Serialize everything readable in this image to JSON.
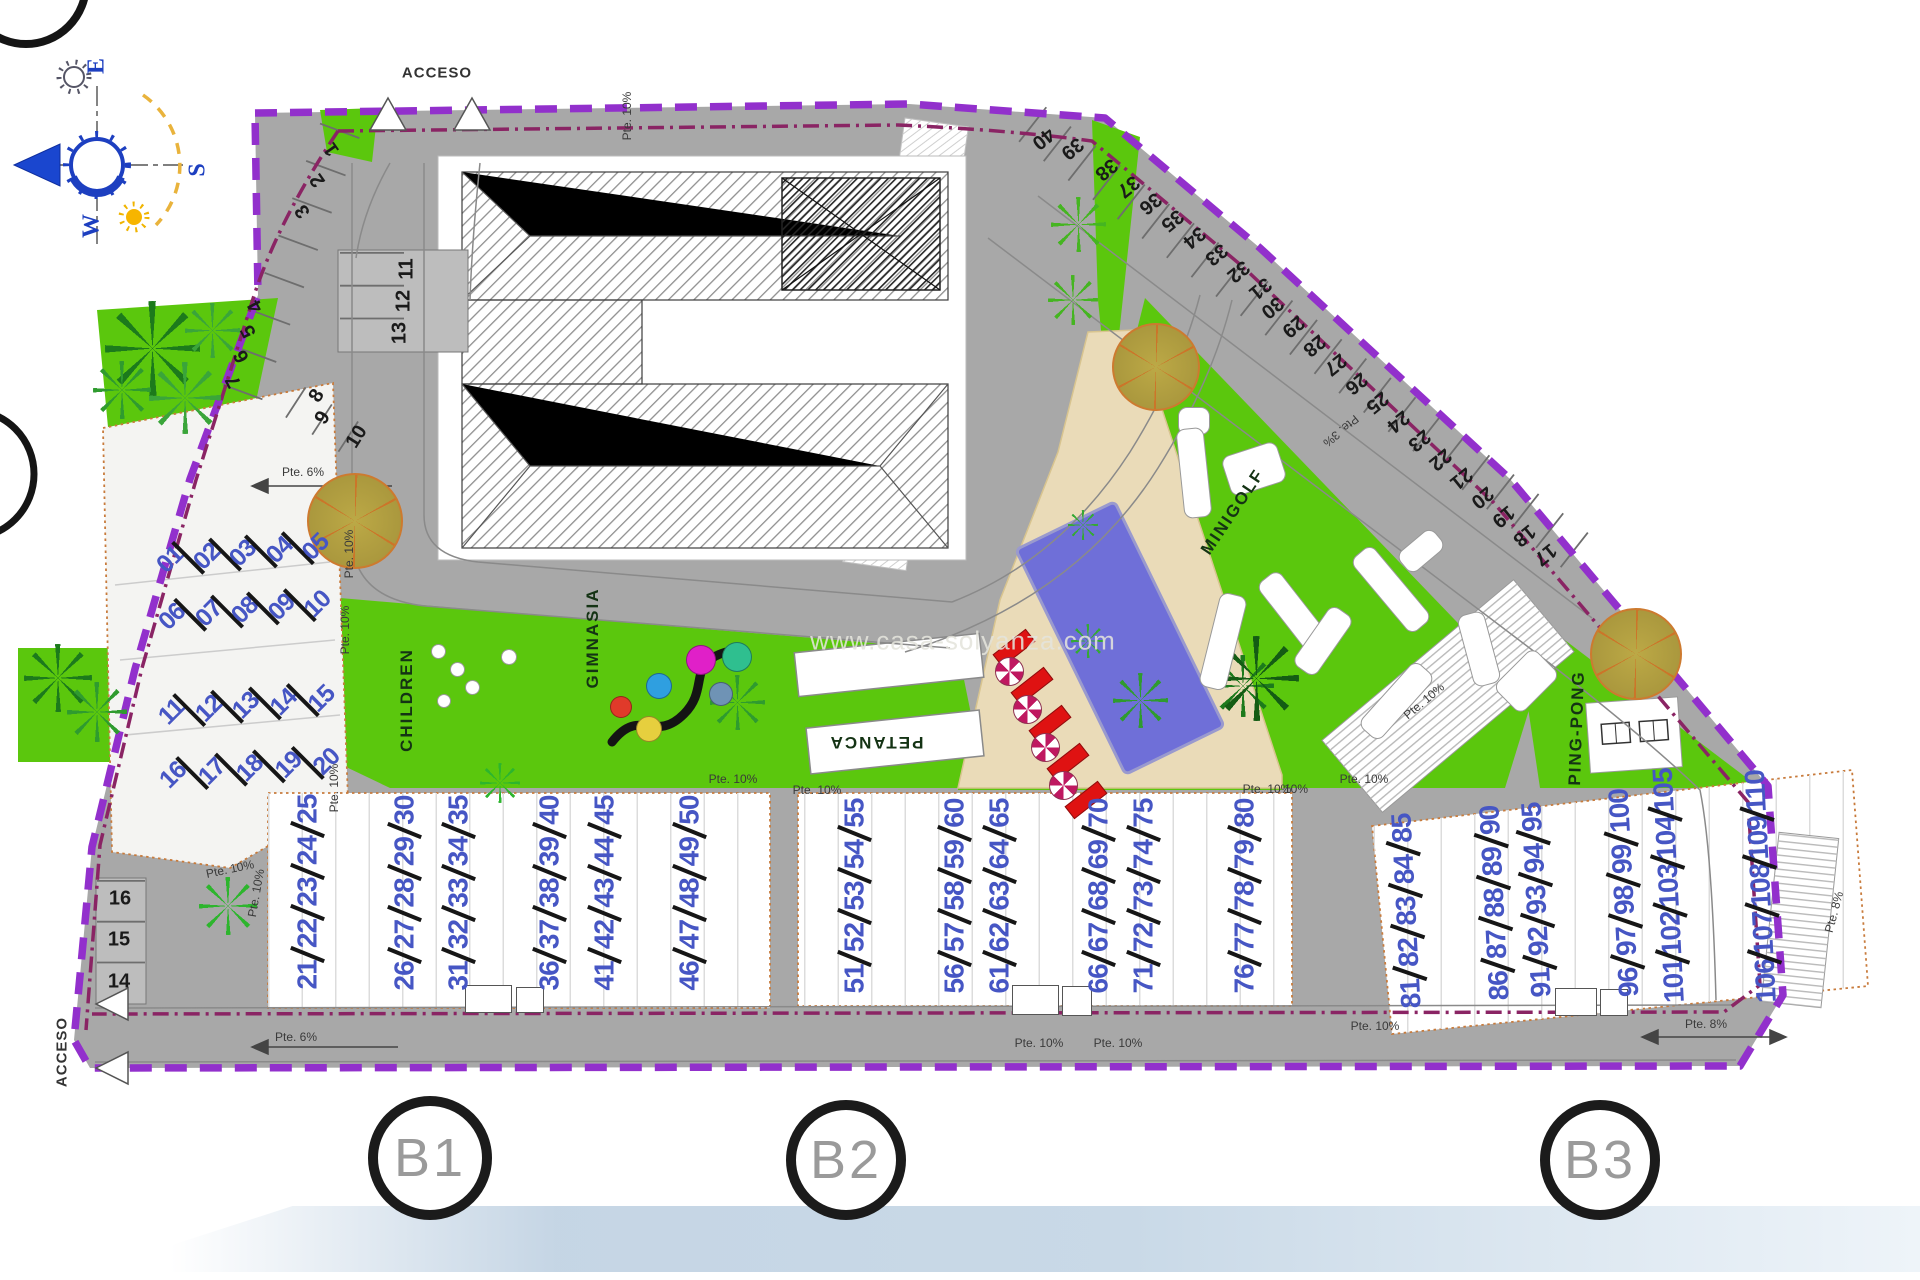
{
  "watermark": "www.casa-solyanza.com",
  "colors": {
    "road": "#a8a8a8",
    "green": "#5bc70d",
    "dark_green": "#1c7a1c",
    "pool": "#6f6fd8",
    "terrace": "#eadbb8",
    "boundary": "#9230cc",
    "boundary_inner": "#8a2464",
    "unit_number": "#4656c4",
    "lounger": "#df1212"
  },
  "texts": [
    {
      "t": "ACCESO",
      "x": 437,
      "y": 73,
      "r": 0,
      "cls": "access",
      "name": "acceso-top-label"
    },
    {
      "t": "ACCESO",
      "x": 62,
      "y": 1052,
      "r": -90,
      "cls": "access",
      "name": "acceso-bottom-label"
    },
    {
      "t": "CHILDREN",
      "x": 407,
      "y": 700,
      "r": -90,
      "cls": "area",
      "name": "children-area-label"
    },
    {
      "t": "GIMNASIA",
      "x": 593,
      "y": 638,
      "r": -90,
      "cls": "area",
      "name": "gimnasia-area-label"
    },
    {
      "t": "PETANCA",
      "x": 876,
      "y": 742,
      "r": 180,
      "cls": "area",
      "name": "petanca-area-label"
    },
    {
      "t": "MINIGOLF",
      "x": 1233,
      "y": 512,
      "r": -56,
      "cls": "area",
      "name": "minigolf-area-label"
    },
    {
      "t": "PING-PONG",
      "x": 1577,
      "y": 728,
      "r": -88,
      "cls": "area",
      "name": "ping-pong-area-label"
    },
    {
      "t": "E",
      "x": 97,
      "y": 66,
      "r": -90,
      "cls": "compass",
      "name": "compass-east-label"
    },
    {
      "t": "S",
      "x": 198,
      "y": 170,
      "r": -90,
      "cls": "compass",
      "name": "compass-south-label"
    },
    {
      "t": "W",
      "x": 92,
      "y": 226,
      "r": -90,
      "cls": "compass",
      "name": "compass-west-label"
    },
    {
      "t": "Pte. 10%",
      "x": 627,
      "y": 116,
      "r": -90,
      "cls": "slope",
      "name": "slope-label"
    },
    {
      "t": "Pte. 6%",
      "x": 303,
      "y": 472,
      "r": 0,
      "cls": "slope",
      "name": "slope-label"
    },
    {
      "t": "Pte. 10%",
      "x": 349,
      "y": 554,
      "r": -90,
      "cls": "slope",
      "name": "slope-label"
    },
    {
      "t": "Pte. 10%",
      "x": 345,
      "y": 630,
      "r": -90,
      "cls": "slope",
      "name": "slope-label"
    },
    {
      "t": "Pte. 10%",
      "x": 230,
      "y": 869,
      "r": -12,
      "cls": "slope",
      "name": "slope-label"
    },
    {
      "t": "Pte. 10%",
      "x": 256,
      "y": 893,
      "r": -80,
      "cls": "slope",
      "name": "slope-label"
    },
    {
      "t": "Pte. 10%",
      "x": 334,
      "y": 788,
      "r": -90,
      "cls": "slope",
      "name": "slope-label"
    },
    {
      "t": "Pte. 10%",
      "x": 733,
      "y": 779,
      "r": 0,
      "cls": "slope",
      "name": "slope-label"
    },
    {
      "t": "Pte. 10%",
      "x": 817,
      "y": 790,
      "r": 0,
      "cls": "slope",
      "name": "slope-label"
    },
    {
      "t": "Pte. 10%",
      "x": 1267,
      "y": 789,
      "r": 0,
      "cls": "slope",
      "name": "slope-label"
    },
    {
      "t": "Pte. 10%",
      "x": 1039,
      "y": 1043,
      "r": 0,
      "cls": "slope",
      "name": "slope-label"
    },
    {
      "t": "Pte. 10%",
      "x": 1118,
      "y": 1043,
      "r": 0,
      "cls": "slope",
      "name": "slope-label"
    },
    {
      "t": "Pte. 3%",
      "x": 1341,
      "y": 431,
      "r": 140,
      "cls": "slope",
      "name": "slope-label"
    },
    {
      "t": "Pte. 10%",
      "x": 1424,
      "y": 701,
      "r": -40,
      "cls": "slope",
      "name": "slope-label"
    },
    {
      "t": "Pte. 10%",
      "x": 1364,
      "y": 779,
      "r": 0,
      "cls": "slope",
      "name": "slope-label"
    },
    {
      "t": "10%",
      "x": 1296,
      "y": 789,
      "r": 0,
      "cls": "slope",
      "name": "slope-label"
    },
    {
      "t": "Pte. 10%",
      "x": 1375,
      "y": 1026,
      "r": 0,
      "cls": "slope",
      "name": "slope-label"
    },
    {
      "t": "Pte. 8%",
      "x": 1706,
      "y": 1024,
      "r": 0,
      "cls": "slope",
      "name": "slope-label"
    },
    {
      "t": "Pte. 8%",
      "x": 1834,
      "y": 912,
      "r": -75,
      "cls": "slope",
      "name": "slope-label"
    },
    {
      "t": "Pte. 6%",
      "x": 296,
      "y": 1037,
      "r": 0,
      "cls": "slope",
      "name": "slope-label"
    }
  ],
  "parking_spaces": [
    {
      "n": "1",
      "x": 332,
      "y": 149,
      "r": -125
    },
    {
      "n": "2",
      "x": 318,
      "y": 180,
      "r": -125
    },
    {
      "n": "3",
      "x": 303,
      "y": 211,
      "r": -125
    },
    {
      "n": "4",
      "x": 256,
      "y": 306,
      "r": -118
    },
    {
      "n": "5",
      "x": 249,
      "y": 331,
      "r": -118
    },
    {
      "n": "6",
      "x": 242,
      "y": 356,
      "r": -118
    },
    {
      "n": "7",
      "x": 234,
      "y": 381,
      "r": -118
    },
    {
      "n": "8",
      "x": 317,
      "y": 396,
      "r": -58
    },
    {
      "n": "9",
      "x": 323,
      "y": 418,
      "r": -58
    },
    {
      "n": "10",
      "x": 357,
      "y": 437,
      "r": -58
    },
    {
      "n": "11",
      "x": 407,
      "y": 269,
      "r": -90
    },
    {
      "n": "12",
      "x": 404,
      "y": 301,
      "r": -90
    },
    {
      "n": "13",
      "x": 400,
      "y": 333,
      "r": -90
    },
    {
      "n": "14",
      "x": 119,
      "y": 982,
      "r": 0
    },
    {
      "n": "15",
      "x": 119,
      "y": 940,
      "r": 0
    },
    {
      "n": "16",
      "x": 120,
      "y": 899,
      "r": 0
    },
    {
      "n": "17",
      "x": 1545,
      "y": 554,
      "r": 141
    },
    {
      "n": "18",
      "x": 1524,
      "y": 535,
      "r": 141
    },
    {
      "n": "19",
      "x": 1503,
      "y": 516,
      "r": 141
    },
    {
      "n": "20",
      "x": 1482,
      "y": 497,
      "r": 141
    },
    {
      "n": "21",
      "x": 1461,
      "y": 478,
      "r": 141
    },
    {
      "n": "22",
      "x": 1440,
      "y": 459,
      "r": 141
    },
    {
      "n": "23",
      "x": 1419,
      "y": 440,
      "r": 141
    },
    {
      "n": "24",
      "x": 1398,
      "y": 421,
      "r": 141
    },
    {
      "n": "25",
      "x": 1377,
      "y": 402,
      "r": 141
    },
    {
      "n": "26",
      "x": 1356,
      "y": 383,
      "r": 141
    },
    {
      "n": "27",
      "x": 1335,
      "y": 364,
      "r": 141
    },
    {
      "n": "28",
      "x": 1314,
      "y": 345,
      "r": 141
    },
    {
      "n": "29",
      "x": 1293,
      "y": 326,
      "r": 141
    },
    {
      "n": "30",
      "x": 1272,
      "y": 307,
      "r": 141
    },
    {
      "n": "31",
      "x": 1260,
      "y": 288,
      "r": 141
    },
    {
      "n": "32",
      "x": 1238,
      "y": 271,
      "r": 141
    },
    {
      "n": "33",
      "x": 1216,
      "y": 254,
      "r": 141
    },
    {
      "n": "34",
      "x": 1194,
      "y": 237,
      "r": 141
    },
    {
      "n": "35",
      "x": 1172,
      "y": 220,
      "r": 141
    },
    {
      "n": "36",
      "x": 1150,
      "y": 203,
      "r": 141
    },
    {
      "n": "37",
      "x": 1128,
      "y": 186,
      "r": 141
    },
    {
      "n": "38",
      "x": 1106,
      "y": 169,
      "r": 141
    },
    {
      "n": "39",
      "x": 1072,
      "y": 148,
      "r": 141
    },
    {
      "n": "40",
      "x": 1043,
      "y": 138,
      "r": 141
    }
  ],
  "unit_rows": [
    {
      "nums": [
        "01",
        "02",
        "03",
        "04",
        "05"
      ],
      "cx": 243,
      "cy": 553,
      "w": 172,
      "rot": -5,
      "left": true
    },
    {
      "nums": [
        "06",
        "07",
        "08",
        "09",
        "10"
      ],
      "cx": 245,
      "cy": 610,
      "w": 172,
      "rot": -5,
      "left": true
    },
    {
      "nums": [
        "11",
        "12",
        "13",
        "14",
        "15"
      ],
      "cx": 247,
      "cy": 705,
      "w": 176,
      "rot": -5,
      "left": true
    },
    {
      "nums": [
        "16",
        "17",
        "18",
        "19",
        "20"
      ],
      "cx": 250,
      "cy": 768,
      "w": 180,
      "rot": -5,
      "left": true
    },
    {
      "nums": [
        "21",
        "22",
        "23",
        "24",
        "25"
      ],
      "cx": 307,
      "cy": 892,
      "w": 195,
      "rot": -90
    },
    {
      "nums": [
        "26",
        "27",
        "28",
        "29",
        "30"
      ],
      "cx": 404,
      "cy": 893,
      "w": 195,
      "rot": -90
    },
    {
      "nums": [
        "31",
        "32",
        "33",
        "34",
        "35"
      ],
      "cx": 458,
      "cy": 893,
      "w": 195,
      "rot": -90
    },
    {
      "nums": [
        "36",
        "37",
        "38",
        "39",
        "40"
      ],
      "cx": 549,
      "cy": 893,
      "w": 195,
      "rot": -90
    },
    {
      "nums": [
        "41",
        "42",
        "43",
        "44",
        "45"
      ],
      "cx": 604,
      "cy": 893,
      "w": 195,
      "rot": -90
    },
    {
      "nums": [
        "46",
        "47",
        "48",
        "49",
        "50"
      ],
      "cx": 689,
      "cy": 893,
      "w": 195,
      "rot": -90
    },
    {
      "nums": [
        "51",
        "52",
        "53",
        "54",
        "55"
      ],
      "cx": 854,
      "cy": 896,
      "w": 195,
      "rot": -90
    },
    {
      "nums": [
        "56",
        "57",
        "58",
        "59",
        "60"
      ],
      "cx": 954,
      "cy": 896,
      "w": 195,
      "rot": -90
    },
    {
      "nums": [
        "61",
        "62",
        "63",
        "64",
        "65"
      ],
      "cx": 999,
      "cy": 896,
      "w": 195,
      "rot": -90
    },
    {
      "nums": [
        "66",
        "67",
        "68",
        "69",
        "70"
      ],
      "cx": 1098,
      "cy": 896,
      "w": 195,
      "rot": -90
    },
    {
      "nums": [
        "71",
        "72",
        "73",
        "74",
        "75"
      ],
      "cx": 1143,
      "cy": 896,
      "w": 195,
      "rot": -90
    },
    {
      "nums": [
        "76",
        "77",
        "78",
        "79",
        "80"
      ],
      "cx": 1244,
      "cy": 896,
      "w": 195,
      "rot": -90
    },
    {
      "nums": [
        "81",
        "82",
        "83",
        "84",
        "85"
      ],
      "cx": 1406,
      "cy": 911,
      "w": 195,
      "rot": -93
    },
    {
      "nums": [
        "86",
        "87",
        "88",
        "89",
        "90"
      ],
      "cx": 1494,
      "cy": 903,
      "w": 195,
      "rot": -93
    },
    {
      "nums": [
        "91",
        "92",
        "93",
        "94",
        "95"
      ],
      "cx": 1536,
      "cy": 900,
      "w": 195,
      "rot": -93
    },
    {
      "nums": [
        "96",
        "97",
        "98",
        "99",
        "100"
      ],
      "cx": 1624,
      "cy": 893,
      "w": 208,
      "rot": -93
    },
    {
      "nums": [
        "101",
        "102",
        "103",
        "104",
        "105"
      ],
      "cx": 1669,
      "cy": 890,
      "w": 226,
      "rot": -93
    },
    {
      "nums": [
        "106",
        "107",
        "108",
        "109",
        "110"
      ],
      "cx": 1761,
      "cy": 890,
      "w": 226,
      "rot": -93
    }
  ],
  "block_markers": [
    {
      "label": "B1",
      "x": 430,
      "y": 1158,
      "r": 62
    },
    {
      "label": "B2",
      "x": 846,
      "y": 1160,
      "r": 60
    },
    {
      "label": "B3",
      "x": 1600,
      "y": 1160,
      "r": 60
    }
  ],
  "trees": {
    "palms": [
      {
        "x": 152,
        "y": 348,
        "s": 95,
        "c": "#1c7a1c"
      },
      {
        "x": 185,
        "y": 398,
        "s": 72,
        "c": "#3aa53a"
      },
      {
        "x": 122,
        "y": 390,
        "s": 58,
        "c": "#2f9b2f"
      },
      {
        "x": 212,
        "y": 330,
        "s": 55,
        "c": "#3aa53a"
      },
      {
        "x": 58,
        "y": 678,
        "s": 68,
        "c": "#1c7a1c"
      },
      {
        "x": 97,
        "y": 712,
        "s": 60,
        "c": "#2f9b2f"
      },
      {
        "x": 737,
        "y": 702,
        "s": 55,
        "c": "#2f9b2f"
      },
      {
        "x": 1083,
        "y": 525,
        "s": 30,
        "c": "#35a835"
      },
      {
        "x": 1088,
        "y": 641,
        "s": 34,
        "c": "#35a835"
      },
      {
        "x": 1140,
        "y": 700,
        "s": 55,
        "c": "#2f9b2f"
      },
      {
        "x": 1243,
        "y": 686,
        "s": 62,
        "c": "#1c7a1c"
      },
      {
        "x": 1256,
        "y": 678,
        "s": 85,
        "c": "#145c14"
      },
      {
        "x": 1078,
        "y": 224,
        "s": 55,
        "c": "#45b521"
      },
      {
        "x": 1073,
        "y": 300,
        "s": 50,
        "c": "#45b521"
      },
      {
        "x": 228,
        "y": 906,
        "s": 58,
        "c": "#2db52d"
      },
      {
        "x": 500,
        "y": 783,
        "s": 40,
        "c": "#2db52d"
      }
    ],
    "orange": [
      {
        "x": 1154,
        "y": 365,
        "r": 42
      },
      {
        "x": 353,
        "y": 519,
        "r": 46
      },
      {
        "x": 1634,
        "y": 652,
        "r": 44
      }
    ]
  },
  "playground_circles": [
    {
      "x": 700,
      "y": 659,
      "r": 14,
      "c": "#e020c8"
    },
    {
      "x": 736,
      "y": 656,
      "r": 14,
      "c": "#2fbf8f"
    },
    {
      "x": 658,
      "y": 685,
      "r": 12,
      "c": "#2f9fe0"
    },
    {
      "x": 720,
      "y": 693,
      "r": 11,
      "c": "#6f93b5"
    },
    {
      "x": 648,
      "y": 728,
      "r": 12,
      "c": "#e6cf3e"
    },
    {
      "x": 620,
      "y": 706,
      "r": 10,
      "c": "#e03a2a"
    }
  ],
  "minigolf_shapes": [
    {
      "x": 1193,
      "y": 420,
      "w": 30,
      "h": 26,
      "rot": 0
    },
    {
      "x": 1193,
      "y": 472,
      "w": 26,
      "h": 88,
      "rot": -6
    },
    {
      "x": 1253,
      "y": 468,
      "w": 56,
      "h": 40,
      "rot": -18
    },
    {
      "x": 1222,
      "y": 640,
      "w": 26,
      "h": 95,
      "rot": 14
    },
    {
      "x": 1292,
      "y": 610,
      "w": 26,
      "h": 85,
      "rot": -38
    },
    {
      "x": 1322,
      "y": 640,
      "w": 26,
      "h": 70,
      "rot": 35
    },
    {
      "x": 1390,
      "y": 588,
      "w": 26,
      "h": 95,
      "rot": -40
    },
    {
      "x": 1420,
      "y": 550,
      "w": 44,
      "h": 24,
      "rot": -40
    },
    {
      "x": 1395,
      "y": 700,
      "w": 85,
      "h": 26,
      "rot": -48
    },
    {
      "x": 1478,
      "y": 648,
      "w": 26,
      "h": 72,
      "rot": -15
    },
    {
      "x": 1525,
      "y": 680,
      "w": 55,
      "h": 38,
      "rot": -45
    },
    {
      "x": 437,
      "y": 650,
      "w": 13,
      "h": 13,
      "rot": -35
    },
    {
      "x": 456,
      "y": 668,
      "w": 13,
      "h": 13,
      "rot": -35
    },
    {
      "x": 471,
      "y": 686,
      "w": 13,
      "h": 13,
      "rot": -35
    },
    {
      "x": 443,
      "y": 700,
      "w": 12,
      "h": 12,
      "rot": -35
    },
    {
      "x": 508,
      "y": 656,
      "w": 14,
      "h": 14,
      "rot": -8
    }
  ],
  "loungers": [
    {
      "x": 1013,
      "y": 647
    },
    {
      "x": 1031,
      "y": 685
    },
    {
      "x": 1049,
      "y": 723
    },
    {
      "x": 1067,
      "y": 761
    },
    {
      "x": 1085,
      "y": 799
    }
  ],
  "umbrellas": [
    {
      "x": 1008,
      "y": 670
    },
    {
      "x": 1026,
      "y": 708
    },
    {
      "x": 1044,
      "y": 746
    },
    {
      "x": 1062,
      "y": 784
    }
  ],
  "detail_boxes": [
    {
      "x": 465,
      "y": 985,
      "w": 45,
      "h": 26
    },
    {
      "x": 516,
      "y": 987,
      "w": 26,
      "h": 24
    },
    {
      "x": 1012,
      "y": 985,
      "w": 45,
      "h": 28
    },
    {
      "x": 1062,
      "y": 986,
      "w": 28,
      "h": 28
    },
    {
      "x": 1555,
      "y": 988,
      "w": 40,
      "h": 26
    },
    {
      "x": 1600,
      "y": 989,
      "w": 26,
      "h": 25
    }
  ]
}
